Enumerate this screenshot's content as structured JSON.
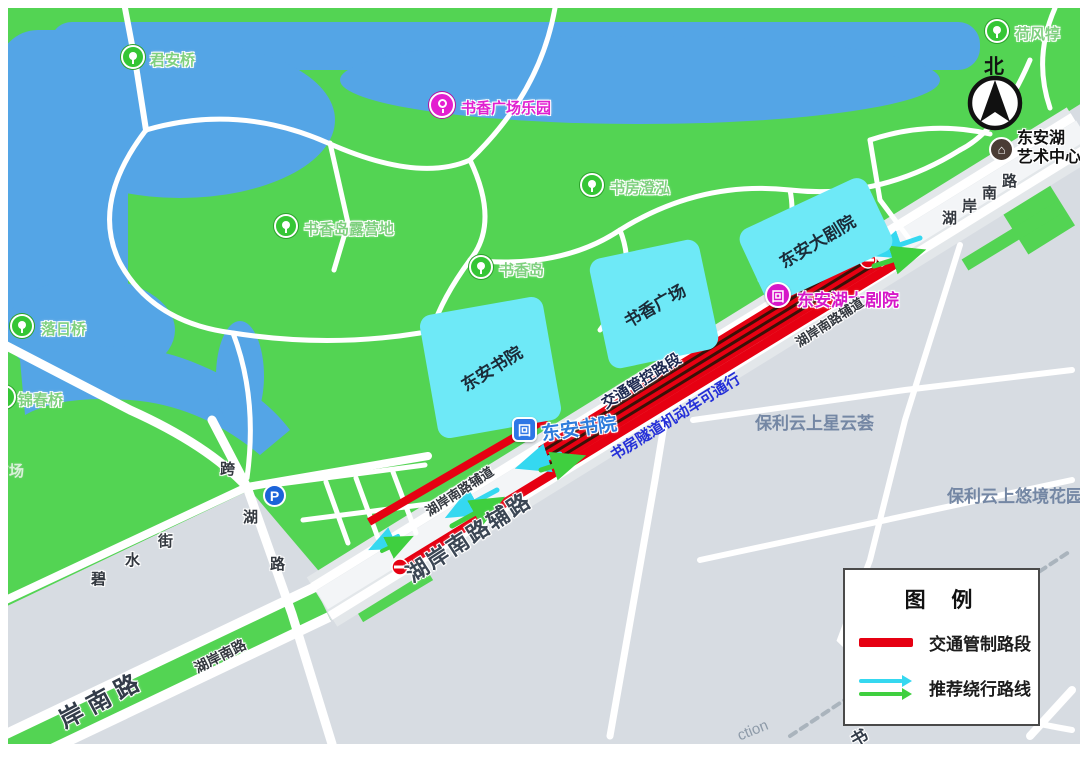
{
  "map": {
    "north_label": "北",
    "pois": [
      {
        "label": "君安桥",
        "type": "park-bridge"
      },
      {
        "label": "书香广场乐园",
        "type": "attraction"
      },
      {
        "label": "书香岛露营地",
        "type": "campsite"
      },
      {
        "label": "书香岛",
        "type": "island"
      },
      {
        "label": "书房澄泓",
        "type": "scenic-spot"
      },
      {
        "label": "落日桥",
        "type": "park-bridge"
      },
      {
        "label": "锦春桥",
        "type": "park-bridge"
      },
      {
        "label": "荷风犉",
        "type": "scenic-spot"
      },
      {
        "label": "东安湖大剧院",
        "type": "metro-station"
      },
      {
        "label": "东安书院",
        "type": "metro-station"
      },
      {
        "label": "东安湖",
        "label2": "艺术中心",
        "type": "art-center"
      },
      {
        "label": "P",
        "type": "parking"
      }
    ],
    "buildings": [
      {
        "label": "东安书院"
      },
      {
        "label": "书香广场"
      },
      {
        "label": "东安大剧院"
      }
    ],
    "districts": [
      {
        "label": "保利云上星云荟"
      },
      {
        "label": "保利云上悠境花园"
      }
    ],
    "roads": {
      "hu_an_south_chars": [
        "湖",
        "岸",
        "南",
        "路"
      ],
      "bishui_chars": [
        "碧",
        "水",
        "街"
      ],
      "kuahu_chars": [
        "跨",
        "湖",
        "路"
      ],
      "hu_an_small": "湖岸南路",
      "an_nan_lu": "岸南路",
      "fudao": "湖岸南路辅道",
      "fulu": "湖岸南路辅路",
      "partial_en": "ction",
      "partial_shu": "书",
      "partial_plaza": "广场"
    },
    "annotations": {
      "control": "交通管控路段",
      "tunnel": "书房隧道机动车可通行"
    }
  },
  "legend": {
    "title": "图 例",
    "item1": "交通管制路段",
    "item2": "推荐绕行路线"
  },
  "colors": {
    "park": "#53d453",
    "water": "#54a5e6",
    "building": "#6ee9f7",
    "restricted": "#e60012",
    "detour_cyan": "#35d8f0",
    "detour_green": "#3fcf3f",
    "urban": "#d7dce2"
  }
}
